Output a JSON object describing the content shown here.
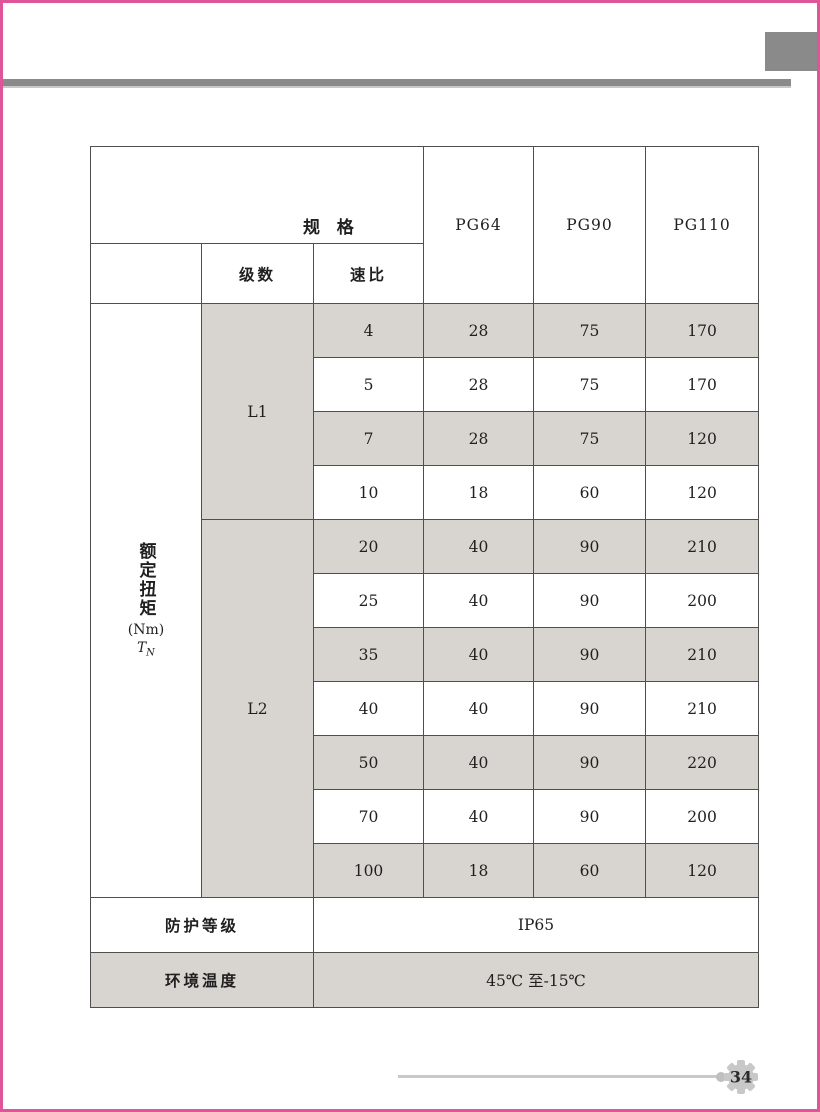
{
  "page": {
    "number": "34"
  },
  "colors": {
    "accent_pink": "#e0559a",
    "decoration_gray": "#8a8a8a",
    "cell_shade": "#d8d5d0",
    "grid_line": "#4f4f4f",
    "footer_line_gray": "#c9c9c9",
    "gear_gray": "#c8c8c8"
  },
  "table": {
    "corner": {
      "top_label": "规 格",
      "bottom_label": "技术参数"
    },
    "subheaders": {
      "stages": "级数",
      "ratio": "速比"
    },
    "spec_columns": [
      "PG64",
      "PG90",
      "PG110"
    ],
    "row_group_label": {
      "title_vertical": "额定扭矩",
      "unit": "(Nm)",
      "symbol": "T",
      "symbol_sub": "N"
    },
    "stage_groups": {
      "l1": "L1",
      "l2": "L2"
    },
    "data_rows": [
      {
        "ratio": "4",
        "pg64": "28",
        "pg90": "75",
        "pg110": "170"
      },
      {
        "ratio": "5",
        "pg64": "28",
        "pg90": "75",
        "pg110": "170"
      },
      {
        "ratio": "7",
        "pg64": "28",
        "pg90": "75",
        "pg110": "120"
      },
      {
        "ratio": "10",
        "pg64": "18",
        "pg90": "60",
        "pg110": "120"
      },
      {
        "ratio": "20",
        "pg64": "40",
        "pg90": "90",
        "pg110": "210"
      },
      {
        "ratio": "25",
        "pg64": "40",
        "pg90": "90",
        "pg110": "200"
      },
      {
        "ratio": "35",
        "pg64": "40",
        "pg90": "90",
        "pg110": "210"
      },
      {
        "ratio": "40",
        "pg64": "40",
        "pg90": "90",
        "pg110": "210"
      },
      {
        "ratio": "50",
        "pg64": "40",
        "pg90": "90",
        "pg110": "220"
      },
      {
        "ratio": "70",
        "pg64": "40",
        "pg90": "90",
        "pg110": "200"
      },
      {
        "ratio": "100",
        "pg64": "18",
        "pg90": "60",
        "pg110": "120"
      }
    ],
    "protection": {
      "label": "防护等级",
      "value": "IP65"
    },
    "temperature": {
      "label": "环境温度",
      "value": "45℃ 至-15℃"
    }
  }
}
